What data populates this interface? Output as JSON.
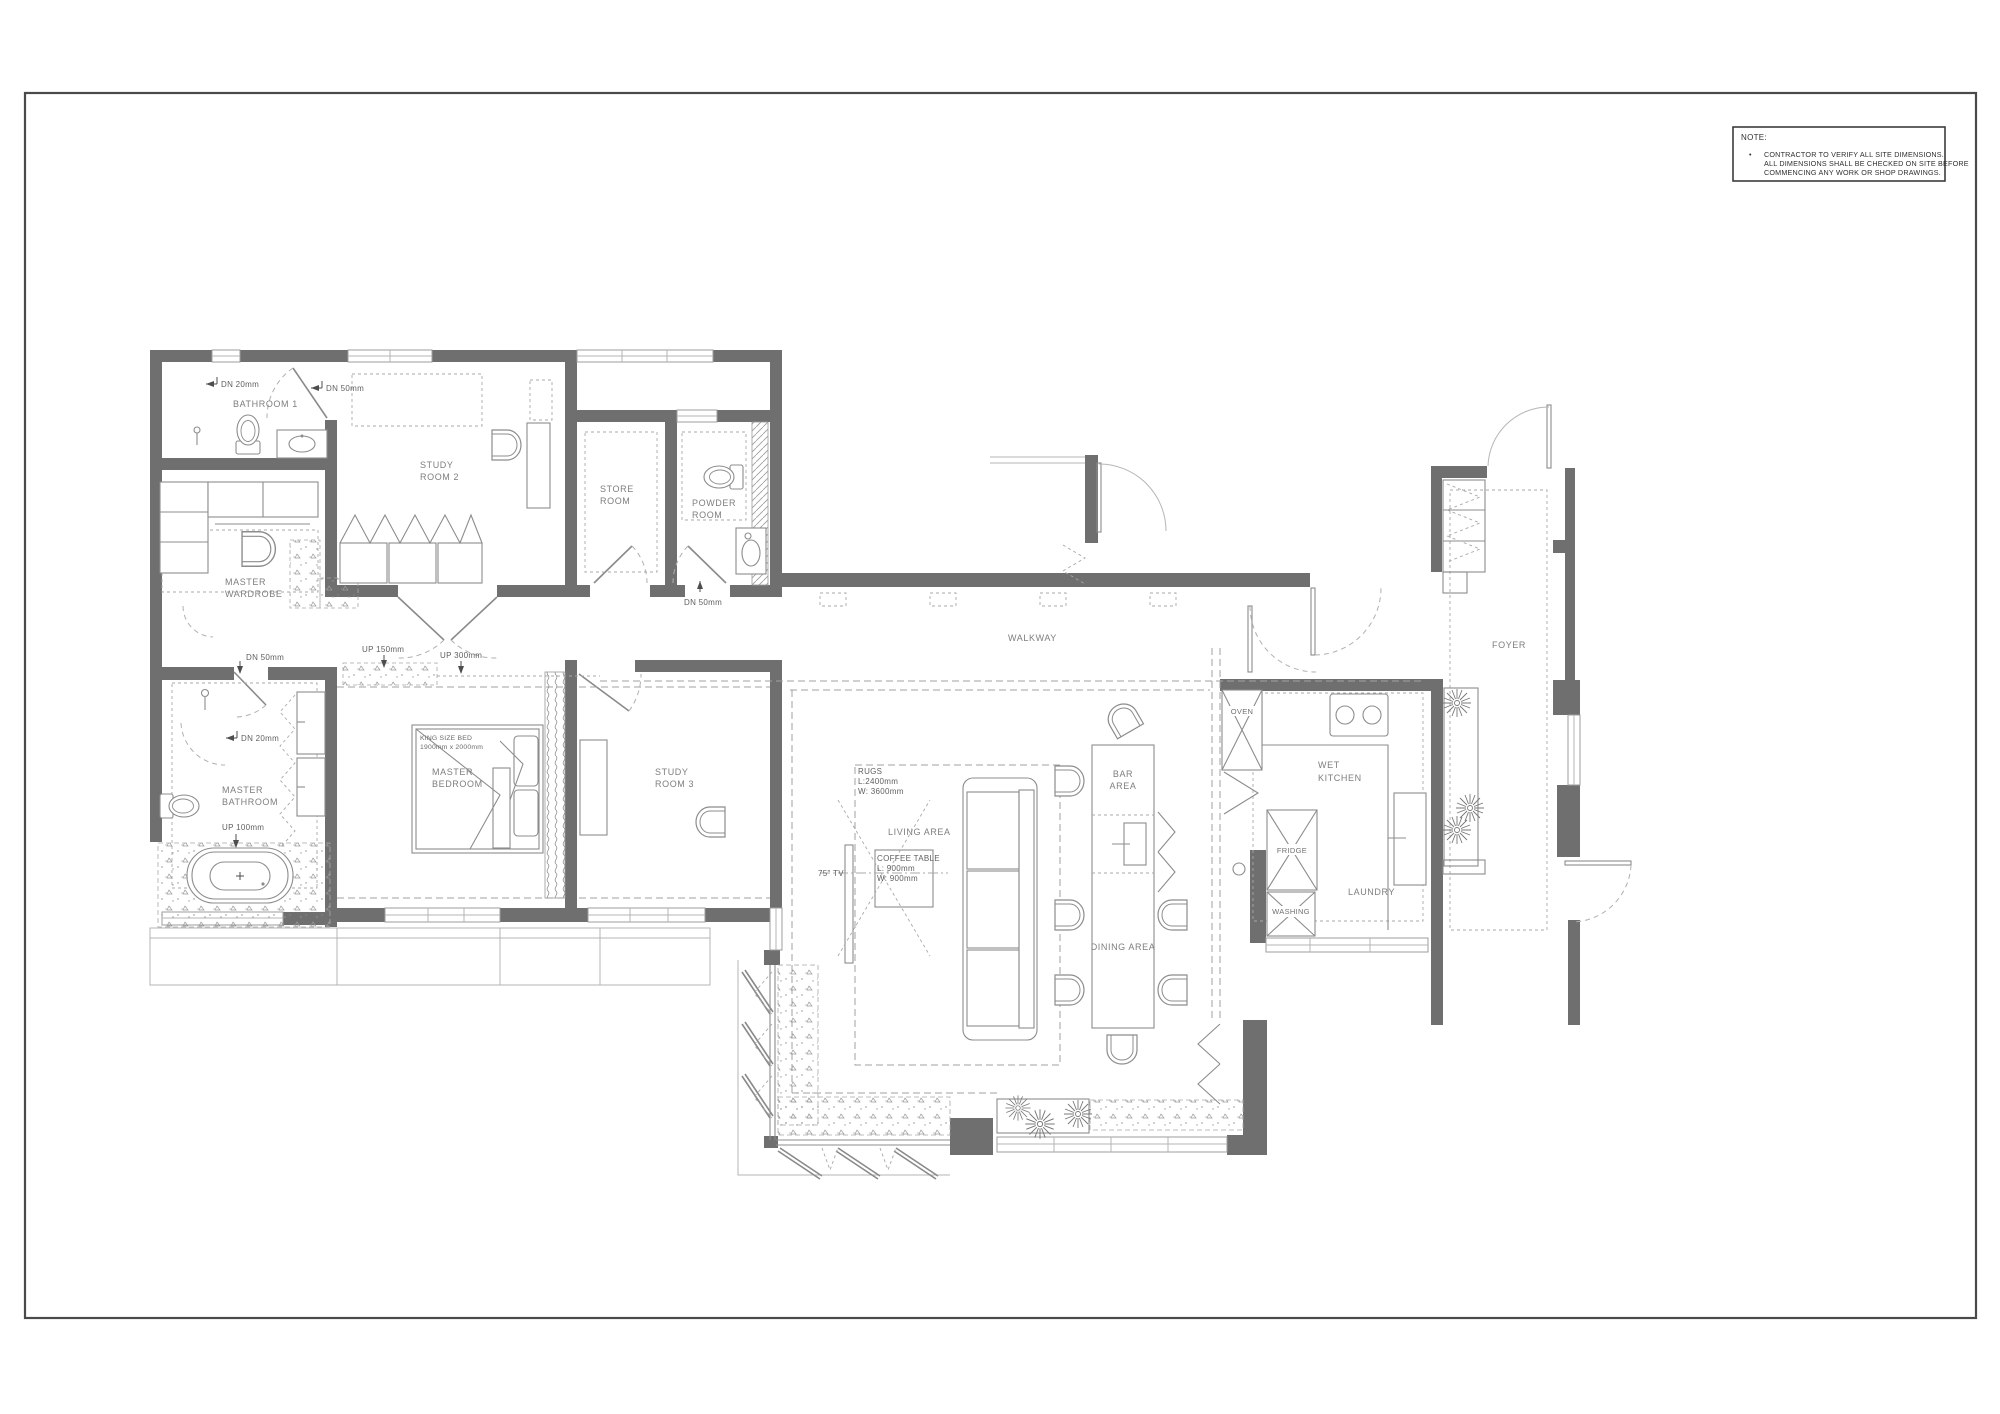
{
  "sheet": {
    "note": {
      "title": "NOTE:",
      "bullet": "•",
      "lines": [
        "CONTRACTOR TO VERIFY ALL SITE DIMENSIONS.",
        "ALL DIMENSIONS SHALL BE CHECKED ON SITE BEFORE",
        "COMMENCING ANY WORK OR SHOP DRAWINGS."
      ]
    }
  },
  "rooms": {
    "bathroom_1": "BATHROOM 1",
    "study_room_2": [
      "STUDY",
      "ROOM 2"
    ],
    "store_room": [
      "STORE",
      "ROOM"
    ],
    "powder_room": [
      "POWDER",
      "ROOM"
    ],
    "master_wardrobe": [
      "MASTER",
      "WARDROBE"
    ],
    "master_bathroom": [
      "MASTER",
      "BATHROOM"
    ],
    "master_bedroom": [
      "MASTER",
      "BEDROOM"
    ],
    "study_room_3": [
      "STUDY",
      "ROOM 3"
    ],
    "walkway": "WALKWAY",
    "living_area": "LIVING AREA",
    "bar_area": [
      "BAR",
      "AREA"
    ],
    "dining_area": "DINING AREA",
    "wet_kitchen": [
      "WET",
      "KITCHEN"
    ],
    "laundry": "LAUNDRY",
    "foyer": "FOYER"
  },
  "fixtures": {
    "oven": "OVEN",
    "fridge": "FRIDGE",
    "washing_machine": "WASHING"
  },
  "levels": {
    "bath1_dn20": "DN 20mm",
    "bath1_dn50": "DN 50mm",
    "powder_dn50": "DN 50mm",
    "mbath_dn50": "DN 50mm",
    "mbath_dn20": "DN 20mm",
    "mbath_up100": "UP 100mm",
    "corridor_up150": "UP 150mm",
    "corridor_up300": "UP 300mm"
  },
  "furniture_notes": {
    "king_bed": [
      "KING SIZE BED",
      "1900mm x 2000mm"
    ],
    "rugs": [
      "RUGS",
      "L:2400mm",
      "W: 3600mm"
    ],
    "coffee_table": [
      "COFFEE TABLE",
      "L: 900mm",
      "W: 900mm"
    ],
    "tv": "75\" TV"
  },
  "colors": {
    "wall": "#6f6f6f",
    "line": "#8c8c8c",
    "text": "#7e7e7e",
    "sheet_border": "#4a4a4a"
  }
}
